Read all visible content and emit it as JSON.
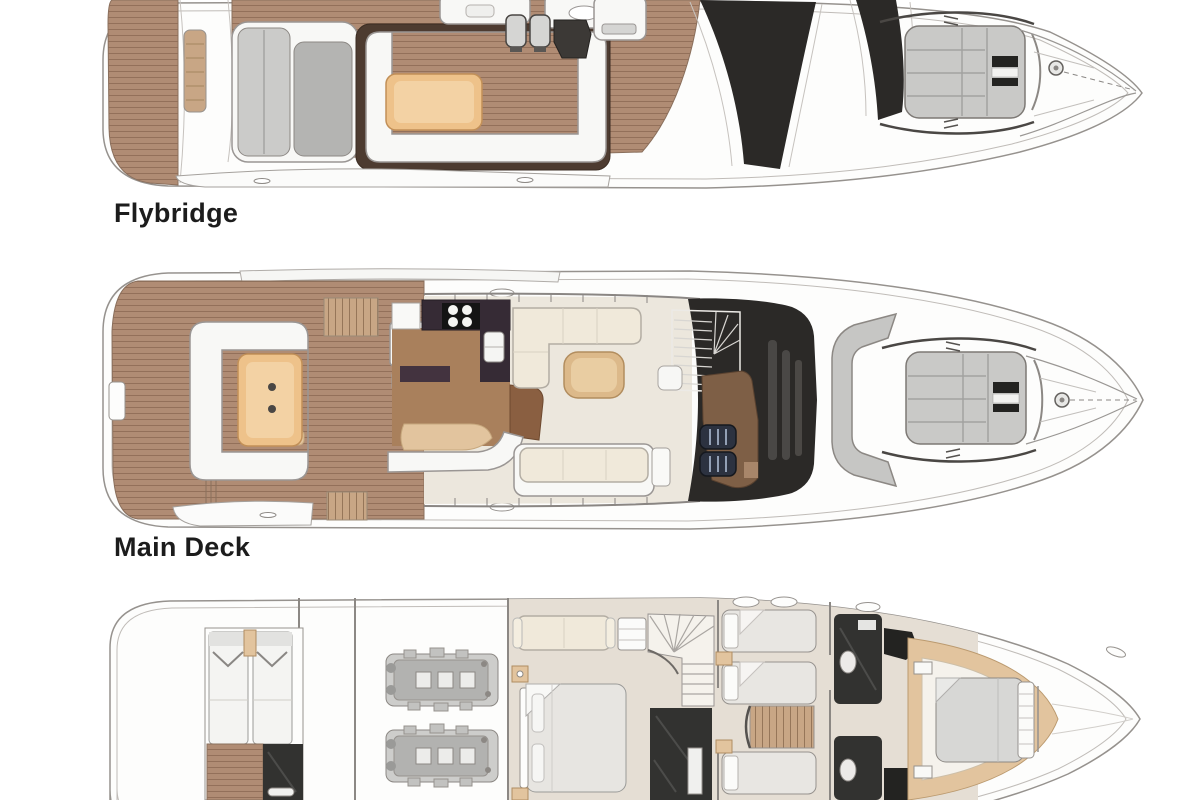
{
  "page": {
    "background_color": "#ffffff",
    "width": 1200,
    "height": 800
  },
  "diagram": {
    "type": "yacht-deck-plan-illustration",
    "orientation": "bow-right",
    "colors": {
      "teak": "#b08c74",
      "teak_light": "#c8a685",
      "glass_dark": "#2b2927",
      "pad_gray": "#c9c9c7",
      "upholstery_cream": "#f0e9da",
      "table_wood": "#eec28a",
      "dark_room": "#323230",
      "trim_tan": "#e2c49e",
      "galley_counter": "#362b35",
      "bar_wood": "#8a5f41",
      "hull_line": "#96928e",
      "label_color": "#1c1c1c"
    },
    "decks": [
      {
        "id": "flybridge",
        "label": "Flybridge",
        "features": [
          "aft-teak-platform",
          "sun-lounger",
          "u-shaped-settee",
          "cockpit-table",
          "wet-bar",
          "twin-helm-seats",
          "windscreen-glass",
          "bow-sun-pad",
          "anchor-windlass"
        ]
      },
      {
        "id": "main-deck",
        "label": "Main Deck",
        "features": [
          "cockpit-settee",
          "cockpit-table",
          "side-deck-steps",
          "galley",
          "saloon-l-sofa",
          "coffee-table",
          "aft-curved-seat",
          "stairway",
          "helm-console",
          "twin-helm-seats",
          "windshield-glass",
          "bow-seating",
          "bow-sun-pad",
          "anchor-windlass"
        ]
      },
      {
        "id": "lower-deck",
        "label": "",
        "features": [
          "crew-cabin-twin-berths",
          "crew-head",
          "engine-room-twin-engines",
          "midship-cabin-sofa",
          "midship-double-bed",
          "ensuite-head",
          "guest-twin-berths",
          "companionway-steps",
          "forward-heads",
          "vip-double-bed",
          "deck-hatches"
        ]
      }
    ]
  }
}
